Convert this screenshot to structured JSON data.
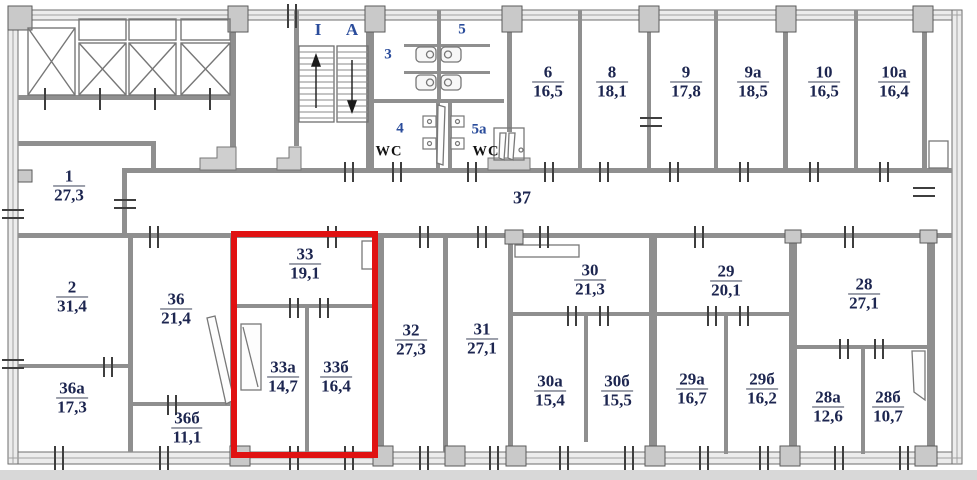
{
  "plan": {
    "type": "building-floor-plan",
    "corridor_label": "37",
    "stairs": {
      "left_flight": "I",
      "right_flight": "A"
    },
    "sanitary": {
      "room3": "3",
      "room4": "4",
      "room5": "5",
      "room5a": "5a",
      "wc_left": "WC",
      "wc_right": "WC"
    },
    "highlight_color": "#e01212",
    "highlighted_rooms": [
      "33",
      "33a",
      "33б"
    ]
  },
  "rooms": [
    {
      "num": "1",
      "area": "27,3"
    },
    {
      "num": "2",
      "area": "31,4"
    },
    {
      "num": "36",
      "area": "21,4"
    },
    {
      "num": "36a",
      "area": "17,3"
    },
    {
      "num": "36б",
      "area": "11,1"
    },
    {
      "num": "33",
      "area": "19,1"
    },
    {
      "num": "33a",
      "area": "14,7"
    },
    {
      "num": "33б",
      "area": "16,4"
    },
    {
      "num": "32",
      "area": "27,3"
    },
    {
      "num": "31",
      "area": "27,1"
    },
    {
      "num": "30",
      "area": "21,3"
    },
    {
      "num": "30a",
      "area": "15,4"
    },
    {
      "num": "30б",
      "area": "15,5"
    },
    {
      "num": "29",
      "area": "20,1"
    },
    {
      "num": "29a",
      "area": "16,7"
    },
    {
      "num": "29б",
      "area": "16,2"
    },
    {
      "num": "28",
      "area": "27,1"
    },
    {
      "num": "28a",
      "area": "12,6"
    },
    {
      "num": "28б",
      "area": "10,7"
    },
    {
      "num": "6",
      "area": "16,5"
    },
    {
      "num": "8",
      "area": "18,1"
    },
    {
      "num": "9",
      "area": "17,8"
    },
    {
      "num": "9a",
      "area": "18,5"
    },
    {
      "num": "10",
      "area": "16,5"
    },
    {
      "num": "10a",
      "area": "16,4"
    }
  ]
}
